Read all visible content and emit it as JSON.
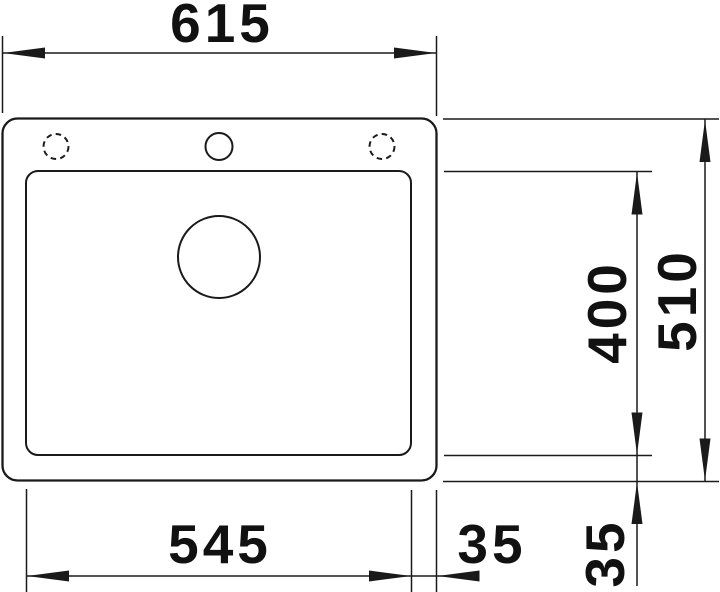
{
  "drawing": {
    "subject": "sink-top-view-dimension-drawing",
    "colors": {
      "line": "#1a1a1a",
      "background": "#ffffff"
    },
    "labels": {
      "width_overall": "615",
      "width_bowl": "545",
      "width_offset": "35",
      "depth_bowl": "400",
      "depth_overall": "510",
      "depth_offset": "35"
    }
  }
}
